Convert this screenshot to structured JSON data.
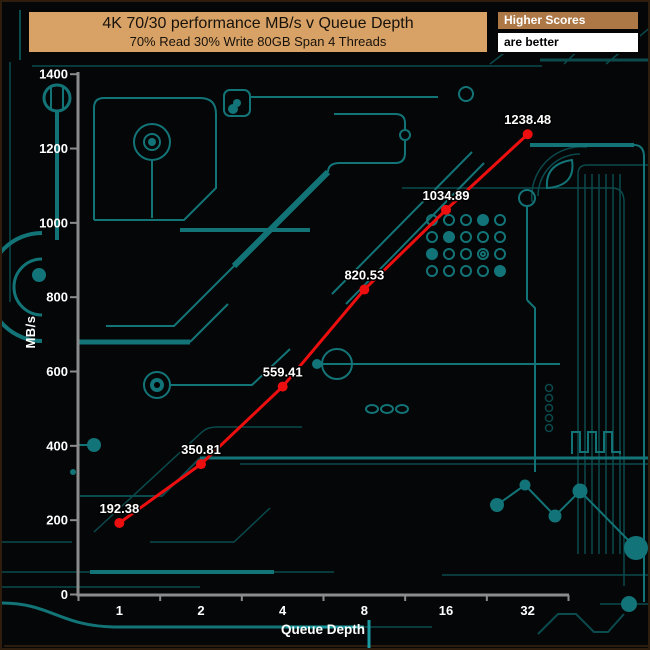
{
  "window": {
    "background": "#040607",
    "border_color": "#2f1e0d"
  },
  "title": {
    "line1": "4K 70/30 performance MB/s v Queue Depth",
    "line2": "70% Read 30% Write 80GB Span 4 Threads",
    "bg": "#d8a266"
  },
  "badge": {
    "label": "Higher Scores",
    "sublabel": "are better",
    "bg": "#ad7746"
  },
  "chart_data": {
    "type": "line",
    "title": "4K 70/30 performance MB/s v Queue Depth",
    "subtitle": "70% Read 30% Write 80GB Span 4 Threads",
    "categories": [
      "1",
      "2",
      "4",
      "8",
      "16",
      "32"
    ],
    "series": [
      {
        "name": "4K 70/30 MB/s",
        "values": [
          192.38,
          350.81,
          559.41,
          820.53,
          1034.89,
          1238.48
        ]
      }
    ],
    "point_labels": [
      "192.38",
      "350.81",
      "559.41",
      "820.53",
      "1034.89",
      "1238.48"
    ],
    "xlabel": "Queue Depth",
    "ylabel": "MB/s",
    "ylim": [
      0,
      1400
    ],
    "yticks": [
      0,
      200,
      400,
      600,
      800,
      1000,
      1200,
      1400
    ],
    "x_scale": "categorical-log2",
    "grid": false,
    "legend": "none",
    "line_color": "#ed0f0f",
    "marker": "circle",
    "label_color": "#ffffff",
    "axis_color": "#8c8c8c",
    "note": "Higher Scores are better"
  },
  "colors": {
    "trace": "#137478",
    "trace_dim": "#0b4a4d",
    "trace_bright": "#1b9ba1",
    "pad": "#127478"
  }
}
